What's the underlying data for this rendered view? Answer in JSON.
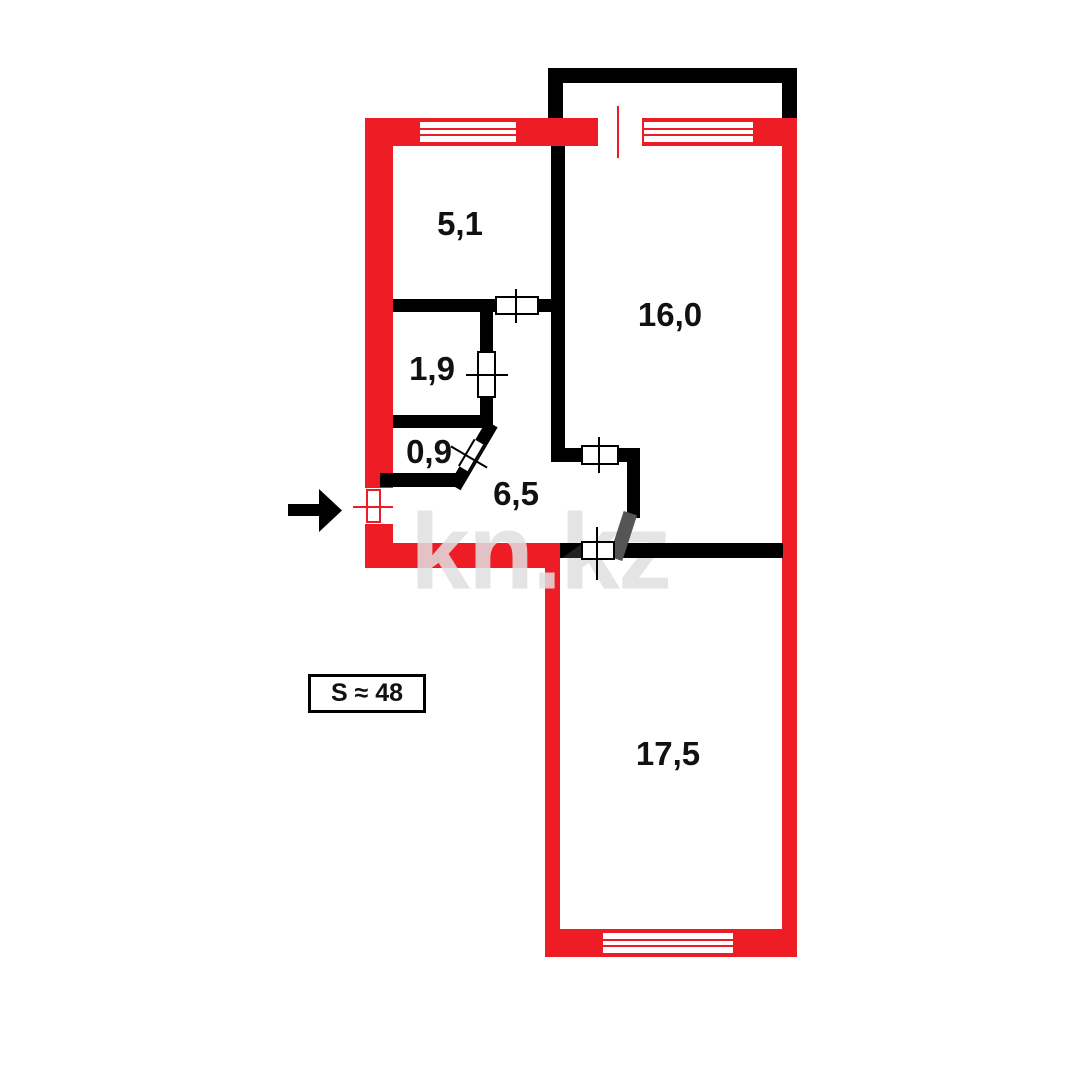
{
  "plan": {
    "total_area_label": "S ≈ 48",
    "watermark": "kn.kz",
    "rooms": [
      {
        "id": "room-5-1",
        "label": "5,1"
      },
      {
        "id": "room-16-0",
        "label": "16,0"
      },
      {
        "id": "room-1-9",
        "label": "1,9"
      },
      {
        "id": "room-0-9",
        "label": "0,9"
      },
      {
        "id": "hallway-6-5",
        "label": "6,5"
      },
      {
        "id": "room-17-5",
        "label": "17,5"
      }
    ],
    "colors": {
      "exterior_wall_red": "#ee1c24",
      "interior_wall_black": "#000000",
      "door_swing_gray": "#555555",
      "watermark_gray": "#e0e0e0"
    }
  }
}
